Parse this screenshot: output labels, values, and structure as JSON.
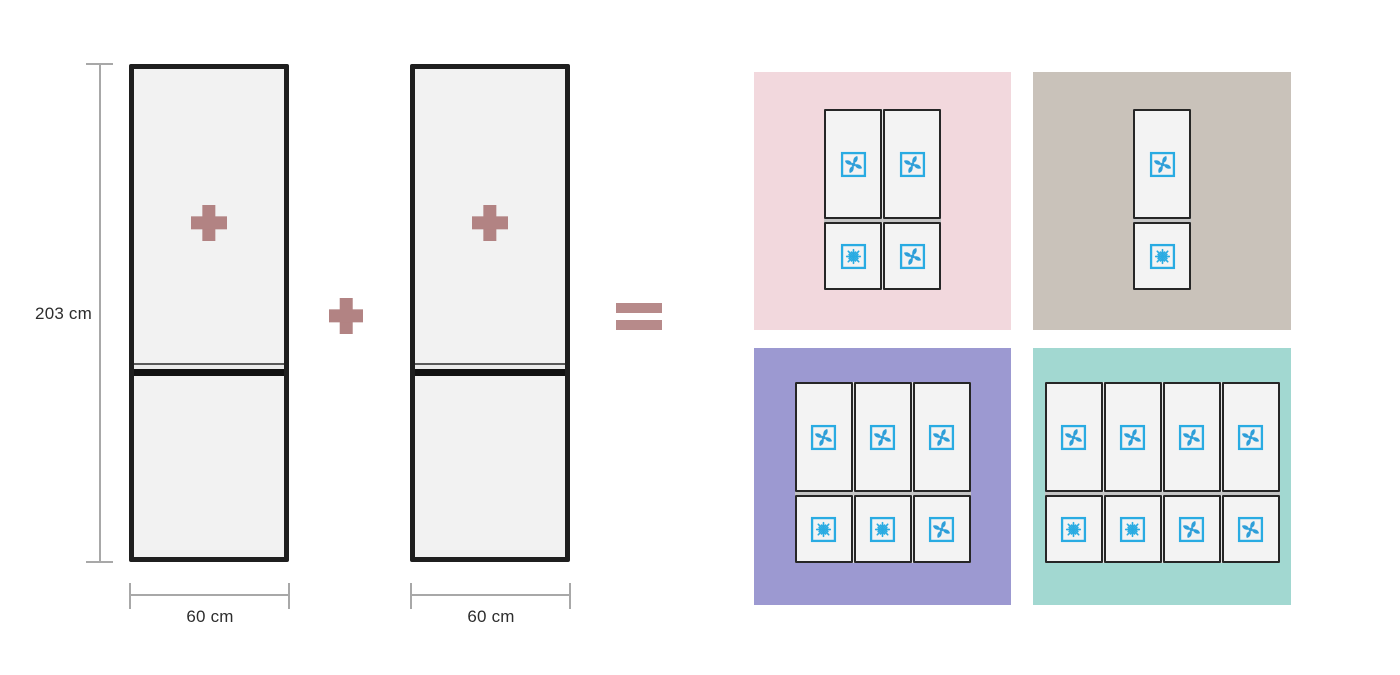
{
  "colors": {
    "background": "#ffffff",
    "plus": "#b28383",
    "equals": "#b78a8a",
    "measure_line": "#a8a8a8",
    "label_text": "#2d2d2d",
    "fridge_border": "#1f1f1f",
    "fridge_fill": "#f2f2f2",
    "door_border": "#262626",
    "door_fill": "#f3f3f3",
    "icon_stroke": "#29abe2",
    "icon_fill": "#2e9fd9"
  },
  "left_diagram": {
    "height_label": "203 cm",
    "operator_between": "plus",
    "operator_result": "equals",
    "fridges": [
      {
        "width_label": "60 cm",
        "has_plus_icon": true
      },
      {
        "width_label": "60 cm",
        "has_plus_icon": true
      }
    ]
  },
  "panels": [
    {
      "id": "pink",
      "position": "top-left",
      "bg": "#f2d8dd",
      "columns": 2,
      "top_row_icons": [
        "fan",
        "fan"
      ],
      "bottom_row_icons": [
        "snowflake",
        "fan"
      ]
    },
    {
      "id": "taupe",
      "position": "top-right",
      "bg": "#c9c2ba",
      "columns": 1,
      "top_row_icons": [
        "fan"
      ],
      "bottom_row_icons": [
        "snowflake"
      ]
    },
    {
      "id": "purple",
      "position": "bottom-left",
      "bg": "#9c99d1",
      "columns": 3,
      "top_row_icons": [
        "fan",
        "fan",
        "fan"
      ],
      "bottom_row_icons": [
        "snowflake",
        "snowflake",
        "fan"
      ]
    },
    {
      "id": "teal",
      "position": "bottom-right",
      "bg": "#a2d8d1",
      "columns": 4,
      "top_row_icons": [
        "fan",
        "fan",
        "fan",
        "fan"
      ],
      "bottom_row_icons": [
        "snowflake",
        "snowflake",
        "fan",
        "fan"
      ]
    }
  ]
}
